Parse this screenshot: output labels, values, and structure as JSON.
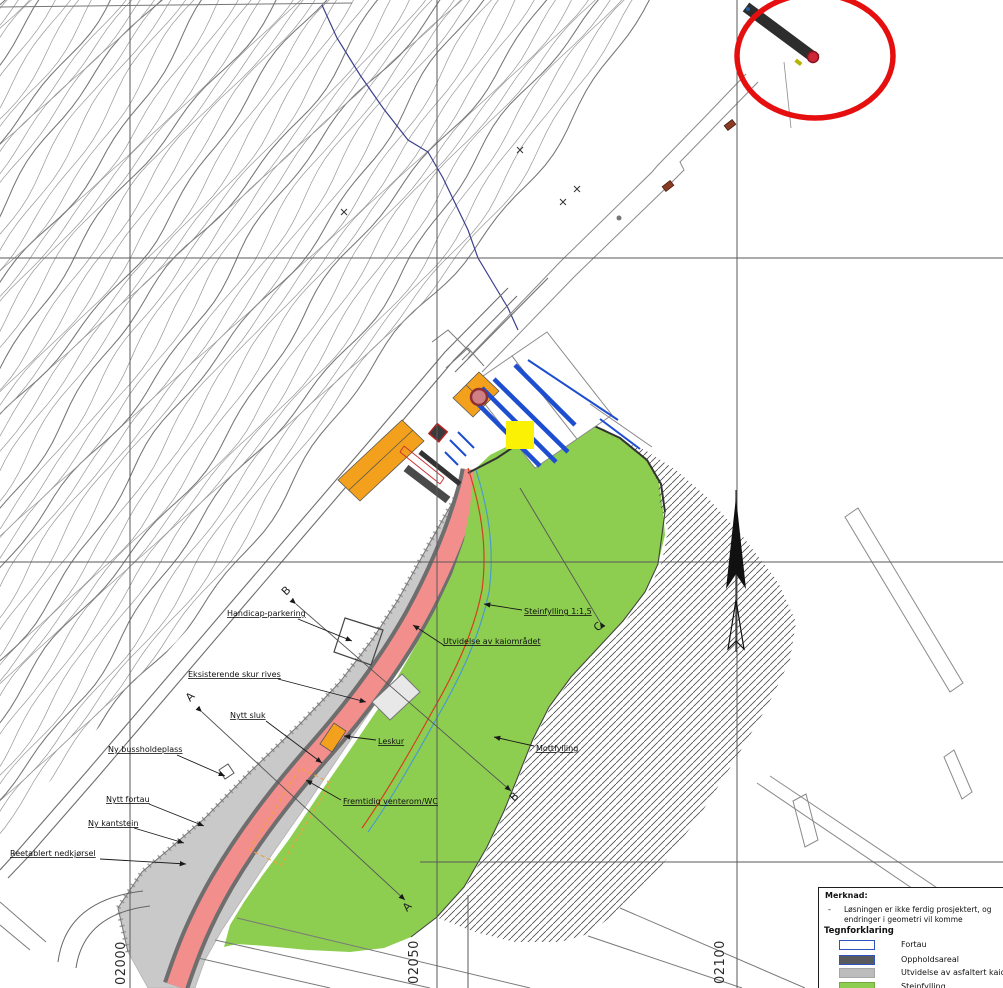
{
  "labels": [
    {
      "text": "Handicap-parkering"
    },
    {
      "text": "Eksisterende skur rives"
    },
    {
      "text": "Nytt sluk"
    },
    {
      "text": "Ny bussholdeplass"
    },
    {
      "text": "Nytt fortau"
    },
    {
      "text": "Ny kantstein"
    },
    {
      "text": "Reetablert nedkjørsel"
    },
    {
      "text": "Utvidelse av kaiområdet"
    },
    {
      "text": "Steinfylling 1:1,5"
    },
    {
      "text": "Leskur"
    },
    {
      "text": "Mottfylling"
    },
    {
      "text": "Fremtidig venterom/WC"
    }
  ],
  "grid": {
    "coordinates": [
      "02000",
      "02050",
      "02100"
    ]
  },
  "sections": {
    "markers": [
      "A",
      "A",
      "B",
      "B",
      "C"
    ]
  },
  "north": {
    "label": "N"
  },
  "legend": {
    "note_title": "Merknad:",
    "note_bullet": "-",
    "note_lines": [
      "Løsningen er ikke ferdig prosjektert, og",
      "endringer i geometri vil komme"
    ],
    "title": "Tegnforklaring",
    "items": [
      {
        "label": "Fortau",
        "fill": "#FFFFFF",
        "border": "#2B52BE"
      },
      {
        "label": "Oppholdsareal",
        "fill": "#595A5E",
        "border": "#2B52BE"
      },
      {
        "label": "Utvidelse av asfaltert kaiområ",
        "fill": "#BCBCBC",
        "border": "#A6A6A6"
      },
      {
        "label": "Steinfylling",
        "fill": "#8DCE50",
        "border": "#74A940"
      }
    ]
  },
  "annotations": {
    "highlight_circle_color": "#E60F0F",
    "highlight_square_color": "#FBF104"
  },
  "colors": {
    "fortau_pink": "#F28E8C",
    "steinfylling_green": "#8DCE50",
    "asphalt_gray": "#C9C9C9",
    "oppholdsareal_dark": "#595A5E",
    "building_orange": "#F3A11C",
    "berth_blue": "#1D4ED0",
    "contour_gray": "#949494"
  }
}
